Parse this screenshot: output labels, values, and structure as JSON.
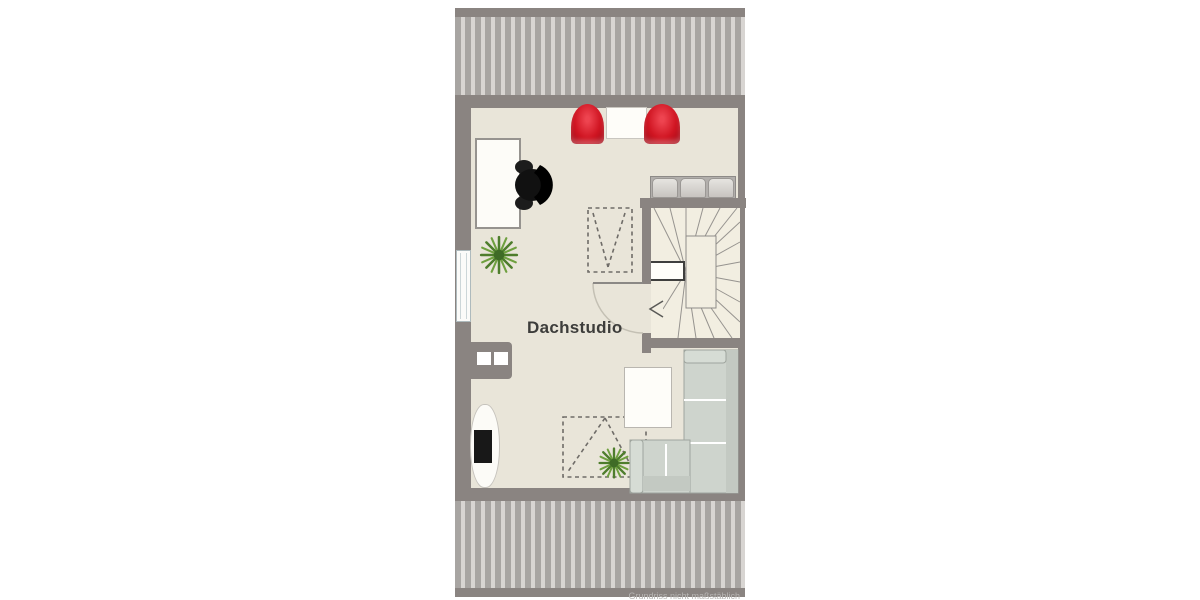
{
  "labels": {
    "room": "Dachstudio",
    "disclaimer": "Grundriss nicht maßstäblich"
  },
  "colors": {
    "wall": "#8a8481",
    "floor": "#e9e5d9",
    "stair_floor": "#f2eee1",
    "hatch_stripe": "#a8a5a2",
    "hatch_gap": "#d8d5d2",
    "chair_red": "#d01522",
    "sofa_gray_green": "#ced4cd",
    "plant_green": "#5d8f3a",
    "furniture_white": "#fdfcf8"
  },
  "furniture": [
    {
      "name": "desk"
    },
    {
      "name": "office-chair"
    },
    {
      "name": "armchair-left"
    },
    {
      "name": "side-table"
    },
    {
      "name": "armchair-right"
    },
    {
      "name": "sideboard"
    },
    {
      "name": "winder-staircase"
    },
    {
      "name": "door"
    },
    {
      "name": "corner-sofa"
    },
    {
      "name": "coffee-table"
    },
    {
      "name": "tv-lowboard"
    },
    {
      "name": "potted-plant-desk"
    },
    {
      "name": "potted-plant-sofa"
    },
    {
      "name": "roof-window-upper"
    },
    {
      "name": "roof-window-lower"
    },
    {
      "name": "wall-window"
    },
    {
      "name": "chimney"
    }
  ]
}
